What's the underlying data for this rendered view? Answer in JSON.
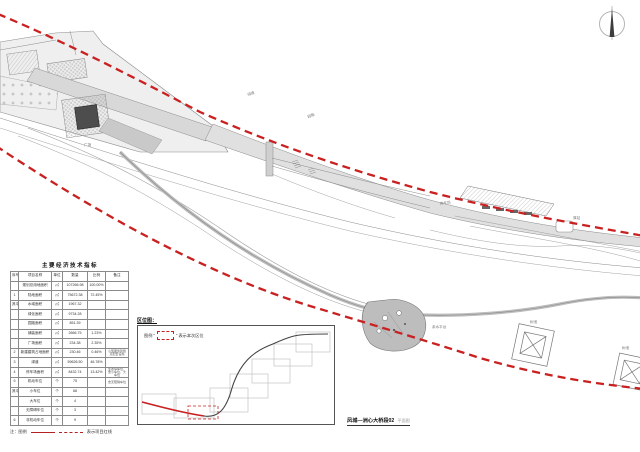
{
  "colors": {
    "redline": "#c92121",
    "plan_fill": "#e4e4e4",
    "plan_fill_dark": "#cfcfcf",
    "stroke": "#8a8a8a",
    "pavilion": "#4d4d4d"
  },
  "compass": {
    "name": "north-arrow"
  },
  "table": {
    "title": "主要经济技术指标",
    "headers": [
      "序号",
      "项目名称",
      "单位",
      "数量",
      "比例",
      "备注"
    ],
    "rows": [
      [
        "",
        "规划总用地面积",
        "㎡",
        "107266.98",
        "100.00%",
        ""
      ],
      [
        "1",
        "陆地面积",
        "㎡",
        "75672.38",
        "72.45%",
        ""
      ],
      [
        "其中",
        "水域面积",
        "㎡",
        "1967.32",
        "",
        ""
      ],
      [
        "",
        "绿化面积",
        "㎡",
        "9734.28",
        "",
        ""
      ],
      [
        "",
        "园路面积",
        "㎡",
        "851.39",
        "",
        ""
      ],
      [
        "",
        "铺装面积",
        "㎡",
        "2666.75",
        "1.23%",
        ""
      ],
      [
        "",
        "广场面积",
        "㎡",
        "234.38",
        "2.35%",
        ""
      ],
      [
        "2",
        "新建建筑占地面积",
        "㎡",
        "230.46",
        "0.46%",
        "小型服务建筑及配套设施"
      ],
      [
        "3",
        "绿道",
        "㎡",
        "59626.50",
        "46.78%",
        ""
      ],
      [
        "4",
        "停车场面积",
        "㎡",
        "8432.74",
        "13.42%",
        "生态停车位，含小车位、大车位"
      ],
      [
        "5",
        "机动车位",
        "个",
        "75",
        "",
        "含无障碍车位"
      ],
      [
        "其中",
        "小车位",
        "个",
        "68",
        "",
        ""
      ],
      [
        "",
        "大车位",
        "个",
        "4",
        "",
        ""
      ],
      [
        "",
        "无障碍车位",
        "个",
        "3",
        "",
        ""
      ],
      [
        "6",
        "非机动车位",
        "个",
        "9",
        "",
        ""
      ]
    ]
  },
  "legend_note": {
    "prefix": "注：图例",
    "suffix": "表示项目红线"
  },
  "location_map": {
    "title": "区位图：",
    "legend_prefix": "图例 “",
    "legend_suffix": "” 表示本次区位"
  },
  "caption": {
    "main": "凤城—洲心大桥段02",
    "suffix": "平面图"
  },
  "plan_labels": [
    {
      "t": "绿道",
      "x": 248,
      "y": 96,
      "r": -20
    },
    {
      "t": "园路",
      "x": 308,
      "y": 118,
      "r": -20
    },
    {
      "t": "广场",
      "x": 84,
      "y": 146,
      "r": 0
    },
    {
      "t": "驿站",
      "x": 573,
      "y": 219,
      "r": 0
    },
    {
      "t": "停车场",
      "x": 440,
      "y": 205,
      "r": -8
    },
    {
      "t": "亲水平台",
      "x": 432,
      "y": 328,
      "r": 0
    },
    {
      "t": "树池",
      "x": 530,
      "y": 323,
      "r": 0
    },
    {
      "t": "树池",
      "x": 622,
      "y": 349,
      "r": 0
    }
  ]
}
